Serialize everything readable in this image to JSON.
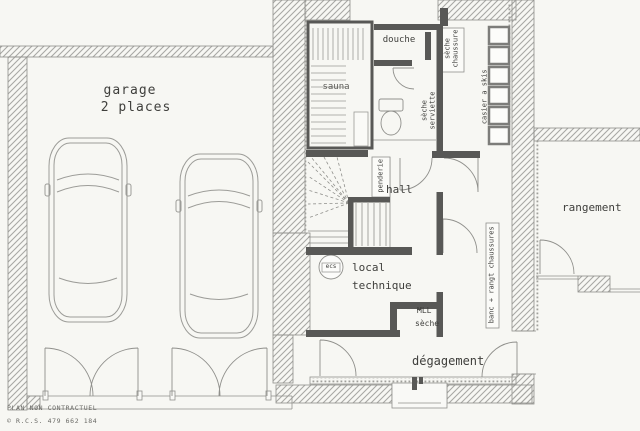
{
  "floor_plan": {
    "labels": {
      "garage": "garage",
      "garage_capacity": "2 places",
      "sauna": "sauna",
      "douche": "douche",
      "seche_serviette": "sèche serviette",
      "seche_chaussure": "sèche chaussure",
      "casier_skis": "casier a skis",
      "penderie": "penderie",
      "hall": "hall",
      "ecs": "ecs",
      "local_technique": "local technique",
      "mll": "MLL",
      "mll_seche": "sèche",
      "degagement": "dégagement",
      "rangement": "rangement",
      "banc_rangt_chaussures": "banc + rangt chaussures"
    },
    "footer": {
      "disclaimer": "PLAN NON CONTRACTUEL",
      "registration": "© R.C.S. 479 662 184"
    },
    "colors": {
      "paper": "#f7f7f3",
      "wall_dark": "#585856",
      "hatch_line": "#a8a8a4",
      "drawing_line": "#90908c",
      "text": "#3f3f3c"
    }
  }
}
